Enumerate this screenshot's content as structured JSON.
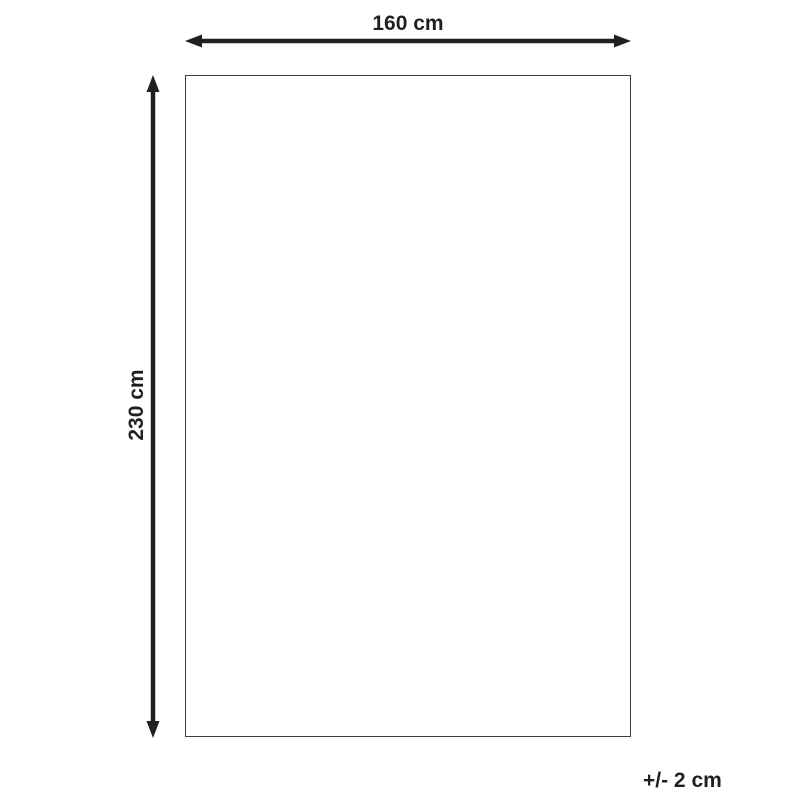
{
  "diagram": {
    "type": "product-dimension-diagram",
    "width_label": "160 cm",
    "height_label": "230 cm",
    "tolerance_label": "+/- 2 cm",
    "colors": {
      "background": "#ffffff",
      "arrow": "#231f20",
      "text": "#231f20",
      "rectangle_border": "#3c3c3b"
    }
  }
}
